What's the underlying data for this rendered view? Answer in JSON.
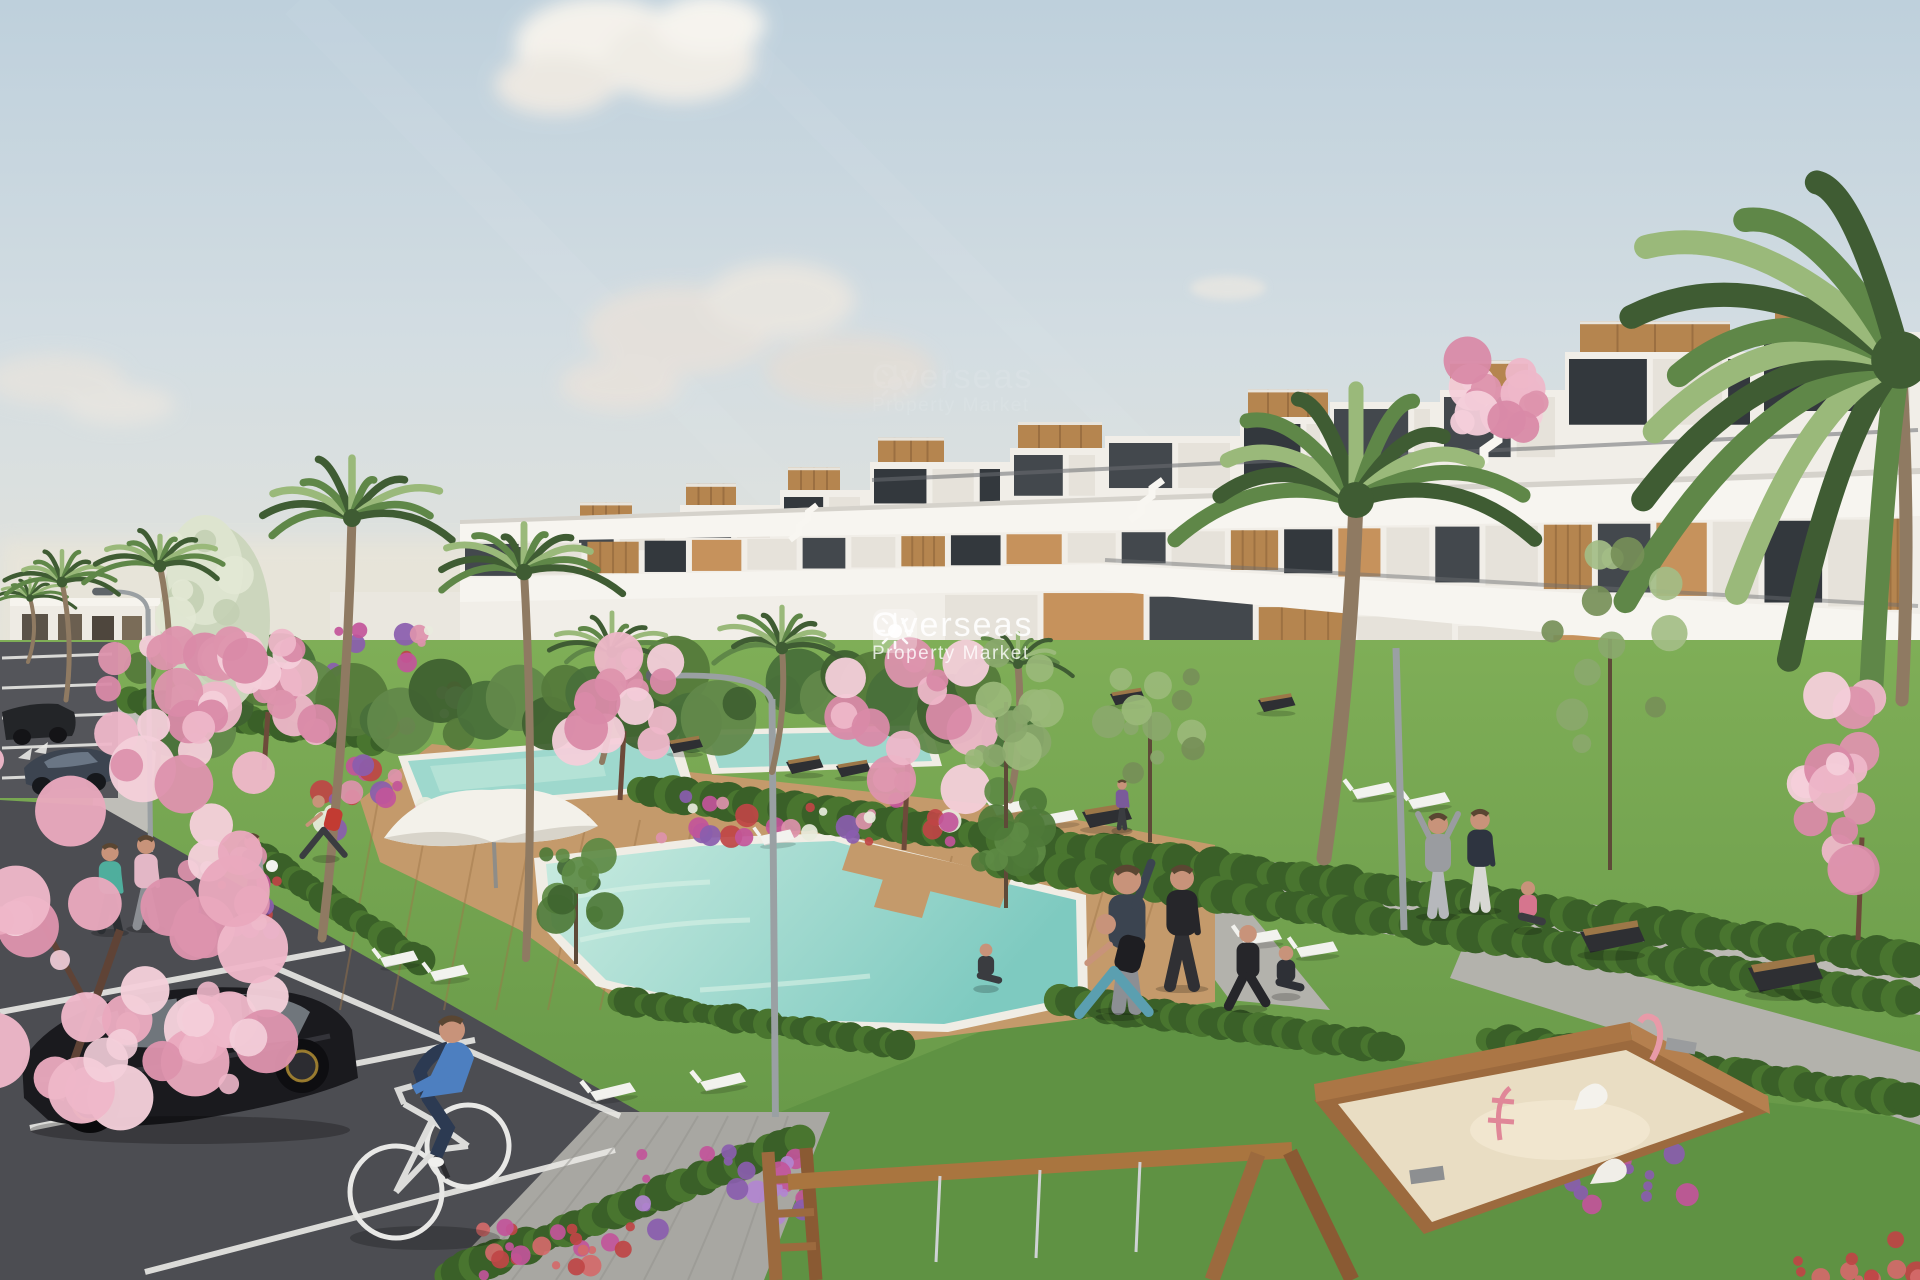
{
  "watermark": {
    "brand": "Overseas",
    "tagline": "Property Market",
    "icon": "sun-icon"
  },
  "palette": {
    "sky_top": "#bed0dc",
    "sky_mid": "#d3dde2",
    "sky_horizon": "#e9e5d9",
    "cloud_white": "#f4f1ea",
    "cloud_gray": "#dcd7d1",
    "building_white": "#f1eee8",
    "building_shade": "#dad6cd",
    "parapet_white": "#f7f5f0",
    "window_glass": "#43484d",
    "window_dark": "#33383d",
    "wood_accent": "#b5854f",
    "wood_dark": "#8a6238",
    "ochre_wall": "#c6925c",
    "palm_green": "#5f8748",
    "palm_dark": "#3f5c33",
    "palm_light": "#9ab97a",
    "lawn_green": "#6fa34b",
    "lawn_light": "#83b25c",
    "lawn_dark": "#55843b",
    "hedge_green": "#3a6028",
    "pool_water": "#8fd2c8",
    "pool_light": "#c9ebe0",
    "deck_wood": "#c49a6b",
    "deck_line": "#9e7648",
    "path_gray": "#b3b2ac",
    "path_light": "#c6c4be",
    "asphalt": "#54555a",
    "asphalt_dark": "#434449",
    "line_white": "#e8e8e4",
    "blossom_pink": "#eeb7c9",
    "blossom_deep": "#dd93ad",
    "blossom_pale": "#f4cfda",
    "sand": "#e9ddc3",
    "play_wood": "#9c6a3e",
    "flower_magenta": "#c2559a",
    "flower_red": "#bf4545",
    "flower_purple": "#8a5dae",
    "flower_white": "#e8ecdd",
    "car_black": "#1a1a1e",
    "car_sedan": "#3c4450",
    "cyclist_blue": "#4d7fc0",
    "bench_dark": "#2e2f33",
    "lounger_white": "#f2f2ee",
    "lamp_gray": "#9aa0a3",
    "trunk_brown": "#8f7a62",
    "skin": "#c8937a"
  }
}
